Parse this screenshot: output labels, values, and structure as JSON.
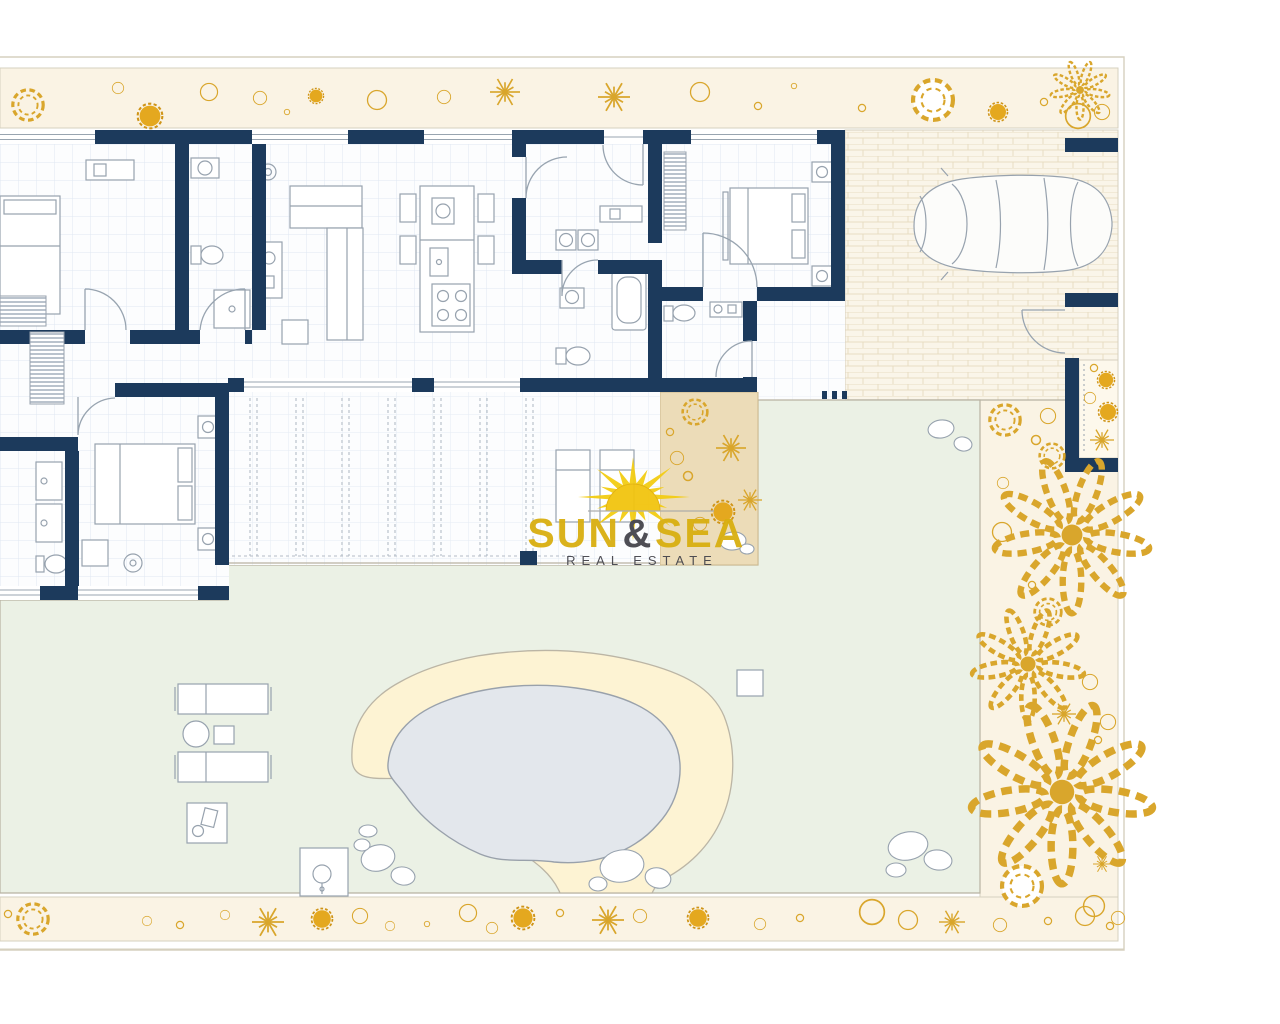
{
  "logo": {
    "word1": "SUN",
    "ampersand": "&",
    "word2": "SEA",
    "subtitle": "REAL ESTATE"
  },
  "palette": {
    "wall": "#1c3a5c",
    "outline": "#97a2ae",
    "glass": "#98a4b0",
    "beam": "#b3bcc6",
    "floor": "#fcfdfe",
    "grid": "#dfe8f2",
    "band": "#faf3e4",
    "band_edge": "#d6d0bf",
    "garden": "#ebf1e5",
    "garden_edge": "#b8b2a2",
    "pool_water": "#e3e7ec",
    "pool_edge": "#99a1ab",
    "deck": "#fdf3d3",
    "deck_edge": "#bbb5a5",
    "tan": "#ecdcb8",
    "tan_edge": "#ccb98e",
    "brick_bg": "#faf5e9",
    "brick_line": "#e8ddc3",
    "gold_stroke": "#d9a62c",
    "gold_fill": "#e4a81f",
    "logo_gold": "#d9af10",
    "logo_dark": "#45454c",
    "sun_fill": "#f3cd14"
  },
  "sun": {
    "cx": 633,
    "cy": 497,
    "rays": 16,
    "outer": 54,
    "outer2": 36,
    "inner": 18,
    "squash": 0.78
  },
  "vegetation": {
    "top_band": [
      {
        "t": "bush",
        "x": 28,
        "y": 105,
        "r": 16
      },
      {
        "t": "circle",
        "x": 118,
        "y": 88,
        "r": 6
      },
      {
        "t": "blob",
        "x": 150,
        "y": 116,
        "r": 13
      },
      {
        "t": "circle",
        "x": 209,
        "y": 92,
        "r": 9
      },
      {
        "t": "circle",
        "x": 260,
        "y": 98,
        "r": 7
      },
      {
        "t": "dot",
        "x": 287,
        "y": 112,
        "r": 3
      },
      {
        "t": "blob",
        "x": 316,
        "y": 96,
        "r": 8
      },
      {
        "t": "circle",
        "x": 377,
        "y": 100,
        "r": 10
      },
      {
        "t": "circle",
        "x": 444,
        "y": 97,
        "r": 7
      },
      {
        "t": "star",
        "x": 505,
        "y": 92,
        "r": 15
      },
      {
        "t": "star",
        "x": 614,
        "y": 97,
        "r": 16
      },
      {
        "t": "circle",
        "x": 700,
        "y": 92,
        "r": 10
      },
      {
        "t": "dot",
        "x": 758,
        "y": 106,
        "r": 4
      },
      {
        "t": "dot",
        "x": 794,
        "y": 86,
        "r": 3
      },
      {
        "t": "dot",
        "x": 862,
        "y": 108,
        "r": 4
      },
      {
        "t": "bushw",
        "x": 933,
        "y": 100,
        "r": 21
      },
      {
        "t": "blob",
        "x": 998,
        "y": 112,
        "r": 10
      },
      {
        "t": "dot",
        "x": 1044,
        "y": 102,
        "r": 4
      },
      {
        "t": "palm",
        "x": 1080,
        "y": 90,
        "r": 22
      },
      {
        "t": "circle",
        "x": 1078,
        "y": 116,
        "r": 13
      },
      {
        "t": "circle",
        "x": 1102,
        "y": 112,
        "r": 8
      }
    ],
    "bottom_band": [
      {
        "t": "bush",
        "x": 33,
        "y": 919,
        "r": 16
      },
      {
        "t": "dot",
        "x": 8,
        "y": 914,
        "r": 4
      },
      {
        "t": "circle",
        "x": 147,
        "y": 921,
        "r": 5
      },
      {
        "t": "dot",
        "x": 180,
        "y": 925,
        "r": 4
      },
      {
        "t": "circle",
        "x": 225,
        "y": 915,
        "r": 5
      },
      {
        "t": "star",
        "x": 268,
        "y": 922,
        "r": 16
      },
      {
        "t": "blob",
        "x": 322,
        "y": 919,
        "r": 11
      },
      {
        "t": "circle",
        "x": 360,
        "y": 916,
        "r": 8
      },
      {
        "t": "circle",
        "x": 390,
        "y": 926,
        "r": 5
      },
      {
        "t": "dot",
        "x": 427,
        "y": 924,
        "r": 3
      },
      {
        "t": "circle",
        "x": 468,
        "y": 913,
        "r": 9
      },
      {
        "t": "circle",
        "x": 492,
        "y": 928,
        "r": 6
      },
      {
        "t": "blob",
        "x": 523,
        "y": 918,
        "r": 12
      },
      {
        "t": "dot",
        "x": 560,
        "y": 913,
        "r": 4
      },
      {
        "t": "star",
        "x": 608,
        "y": 920,
        "r": 16
      },
      {
        "t": "circle",
        "x": 640,
        "y": 916,
        "r": 7
      },
      {
        "t": "blob",
        "x": 698,
        "y": 918,
        "r": 11
      },
      {
        "t": "circle",
        "x": 760,
        "y": 924,
        "r": 6
      },
      {
        "t": "dot",
        "x": 800,
        "y": 918,
        "r": 4
      },
      {
        "t": "circle",
        "x": 872,
        "y": 912,
        "r": 13
      },
      {
        "t": "circle",
        "x": 908,
        "y": 920,
        "r": 10
      },
      {
        "t": "star",
        "x": 952,
        "y": 922,
        "r": 13
      },
      {
        "t": "circle",
        "x": 1000,
        "y": 925,
        "r": 7
      },
      {
        "t": "dot",
        "x": 1048,
        "y": 921,
        "r": 4
      },
      {
        "t": "circle",
        "x": 1085,
        "y": 916,
        "r": 10
      },
      {
        "t": "dot",
        "x": 1110,
        "y": 926,
        "r": 4
      }
    ],
    "right_strip": [
      {
        "t": "bush",
        "x": 1005,
        "y": 420,
        "r": 16
      },
      {
        "t": "circle",
        "x": 1048,
        "y": 416,
        "r": 8
      },
      {
        "t": "dot",
        "x": 1036,
        "y": 440,
        "r": 5
      },
      {
        "t": "bush",
        "x": 1052,
        "y": 456,
        "r": 13
      },
      {
        "t": "circle",
        "x": 1003,
        "y": 483,
        "r": 6
      },
      {
        "t": "palm",
        "x": 1072,
        "y": 535,
        "r": 58
      },
      {
        "t": "circle",
        "x": 1002,
        "y": 532,
        "r": 10
      },
      {
        "t": "dot",
        "x": 1032,
        "y": 585,
        "r": 4
      },
      {
        "t": "bush",
        "x": 1048,
        "y": 612,
        "r": 14
      },
      {
        "t": "palm",
        "x": 1028,
        "y": 664,
        "r": 42
      },
      {
        "t": "circle",
        "x": 1090,
        "y": 682,
        "r": 8
      },
      {
        "t": "star",
        "x": 1064,
        "y": 714,
        "r": 12
      },
      {
        "t": "dot",
        "x": 1098,
        "y": 740,
        "r": 4
      },
      {
        "t": "circle",
        "x": 1108,
        "y": 722,
        "r": 8
      },
      {
        "t": "palm",
        "x": 1062,
        "y": 792,
        "r": 68
      },
      {
        "t": "star",
        "x": 1102,
        "y": 864,
        "r": 9
      },
      {
        "t": "bushw",
        "x": 1022,
        "y": 886,
        "r": 21
      },
      {
        "t": "circle",
        "x": 1094,
        "y": 906,
        "r": 11
      },
      {
        "t": "circle",
        "x": 1118,
        "y": 918,
        "r": 7
      }
    ],
    "tan_patch": [
      {
        "t": "bush",
        "x": 695,
        "y": 412,
        "r": 13
      },
      {
        "t": "star",
        "x": 731,
        "y": 448,
        "r": 15
      },
      {
        "t": "circle",
        "x": 677,
        "y": 458,
        "r": 7
      },
      {
        "t": "dot",
        "x": 688,
        "y": 476,
        "r": 5
      },
      {
        "t": "blob",
        "x": 723,
        "y": 512,
        "r": 12
      },
      {
        "t": "circle",
        "x": 700,
        "y": 524,
        "r": 7
      },
      {
        "t": "dot",
        "x": 670,
        "y": 432,
        "r": 4
      },
      {
        "t": "star",
        "x": 750,
        "y": 500,
        "r": 12
      }
    ],
    "entry_planter": [
      {
        "t": "dot",
        "x": 1094,
        "y": 368,
        "r": 4
      },
      {
        "t": "blob",
        "x": 1106,
        "y": 380,
        "r": 9
      },
      {
        "t": "circle",
        "x": 1090,
        "y": 398,
        "r": 6
      },
      {
        "t": "blob",
        "x": 1108,
        "y": 412,
        "r": 10
      },
      {
        "t": "star",
        "x": 1102,
        "y": 440,
        "r": 12
      }
    ]
  }
}
